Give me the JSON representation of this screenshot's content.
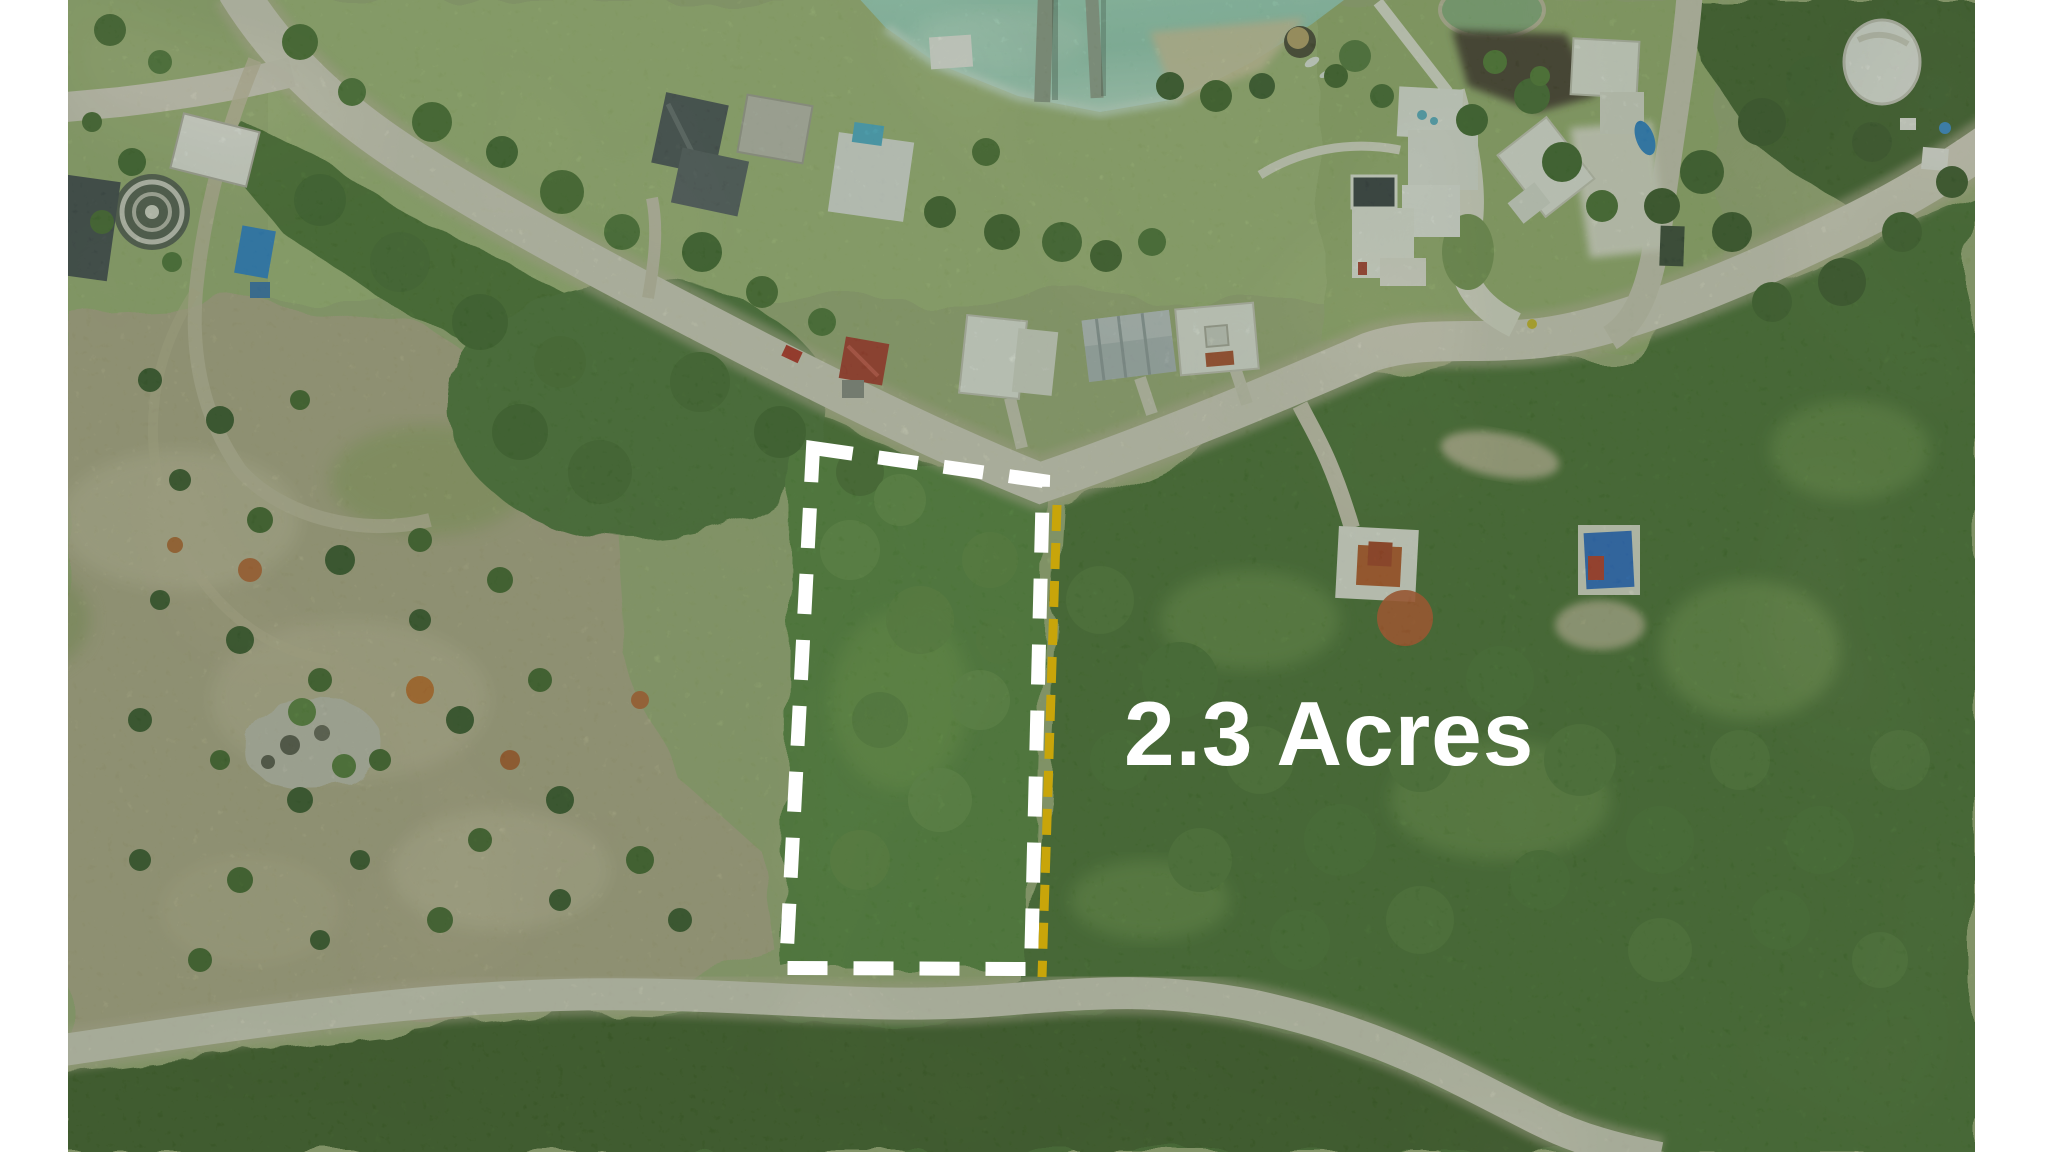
{
  "annotation": {
    "label_text": "2.3 Acres",
    "label_color": "#ffffff",
    "boundary_color": "#ffffff",
    "boundary_style": "dashed",
    "lot_line_color": "#c8a50a"
  },
  "scene": {
    "type": "aerial-drone-photo-of-vacant-lot",
    "water_color": "#9ed5bf",
    "pond_color": "#8fb583",
    "forest_color": "#4d7336",
    "plot_forest_color": "#5a8840",
    "scrub_color": "#b7ae8d",
    "road_color": "#dfd9c9",
    "letterbox_color": "#ffffff"
  }
}
